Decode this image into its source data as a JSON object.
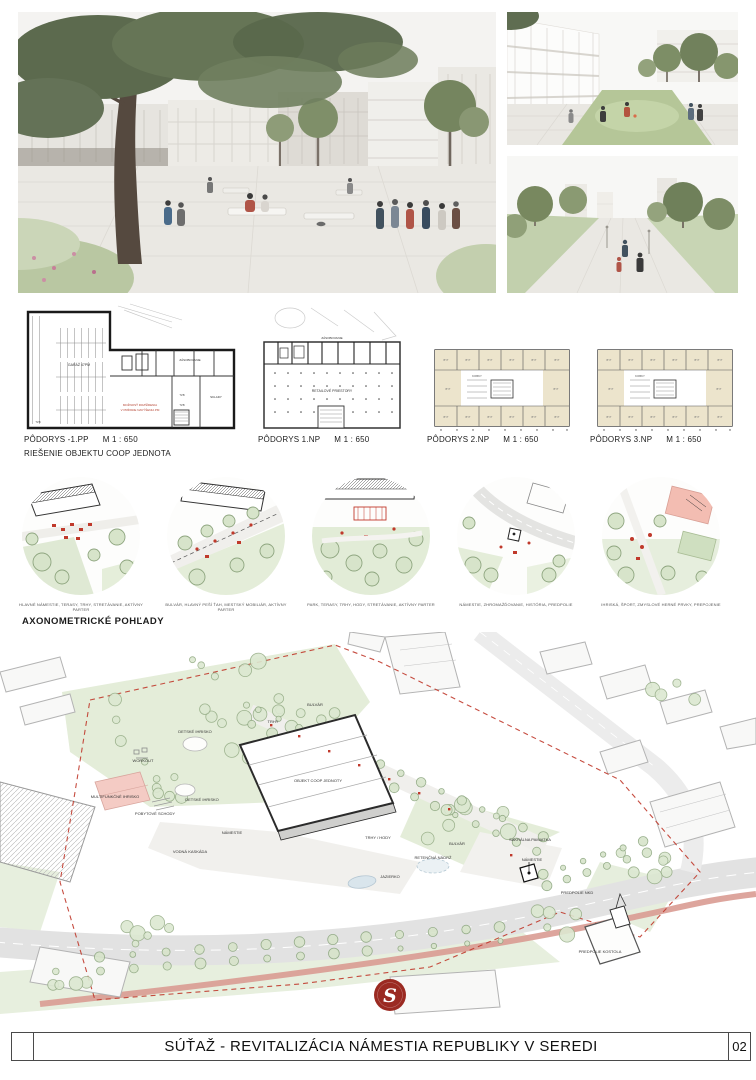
{
  "footer": {
    "title": "SÚŤAŽ - REVITALIZÁCIA NÁMESTIA REPUBLIKY V SEREDI",
    "page_number": "02"
  },
  "plans": [
    {
      "title": "PÔDORYS -1.PP",
      "scale": "M 1 : 650",
      "subtitle": "RIEŠENIE OBJEKTU COOP JEDNOTA",
      "labels": {
        "garage": "GARÁŽ 47PM",
        "note1": "MOŽNOSŤ ROZŠÍRENIA",
        "note2": "V PRÍPADE NAVÝŠENIA PM",
        "supply": "ZÁSOBOVANIE",
        "storage": "SKLADY",
        "tzb": "TZB"
      }
    },
    {
      "title": "PÔDORYS 1.NP",
      "scale": "M 1 : 650",
      "labels": {
        "supply": "ZÁSOBOVANIE",
        "retail": "RETAILOVÉ PRIESTORY"
      }
    },
    {
      "title": "PÔDORYS 2.NP",
      "scale": "M 1 : 650",
      "labels": {
        "room": "BYT",
        "cells": "KOBKY"
      }
    },
    {
      "title": "PÔDORYS 3.NP",
      "scale": "M 1 : 650",
      "labels": {
        "room": "BYT",
        "cells": "KOBKY"
      }
    }
  ],
  "axonometric": {
    "heading": "AXONOMETRICKÉ POHĽADY",
    "views": [
      {
        "caption": "HLAVNÉ NÁMESTIE, TERASY, TRHY, STRETÁVANIE, AKTÍVNY PARTER"
      },
      {
        "caption": "BULVÁR, HLAVNÝ PEŠÍ ŤAH, MESTSKÝ MOBILIÁR, AKTÍVNY PARTER"
      },
      {
        "caption": "PARK, TERASY, TRHY, HODY, STRETÁVANIE, AKTÍVNY PARTER"
      },
      {
        "caption": "NÁMESTIE, ZHROMAŽĎOVANIE, HISTÓRIA, PREDPOLIE"
      },
      {
        "caption": "IHRISKÁ, ŠPORT, ZMYSLOVÉ HERNÉ PRVKY, PREPOJENIE"
      }
    ]
  },
  "siteplan": {
    "labels": [
      "BULVÁR",
      "TRHY",
      "DETSKÉ IHRISKO",
      "WORKOUT",
      "OBJEKT COOP JEDNOTY",
      "MULTIFUNKČNÉ IHRISKO",
      "DETSKÉ IHRISKO",
      "POBYTOVÉ SCHODY",
      "NÁMESTIE",
      "VODNÁ KASKÁDA",
      "TRHY / HODY",
      "SAKRÁLNA PAMIATKA",
      "BULVÁR",
      "RETENČNÁ NÁDRŽ",
      "NÁMESTIE",
      "JAZIERKO",
      "PREDPOLIE NKD",
      "PREDPOLIE KOSTOLA"
    ]
  },
  "logo": {
    "letter": "S"
  },
  "colors": {
    "accent_red": "#c0392b",
    "plan_tan": "#ece4cc",
    "green_light": "#e4edd9",
    "cycle_pink": "#d99b92"
  }
}
